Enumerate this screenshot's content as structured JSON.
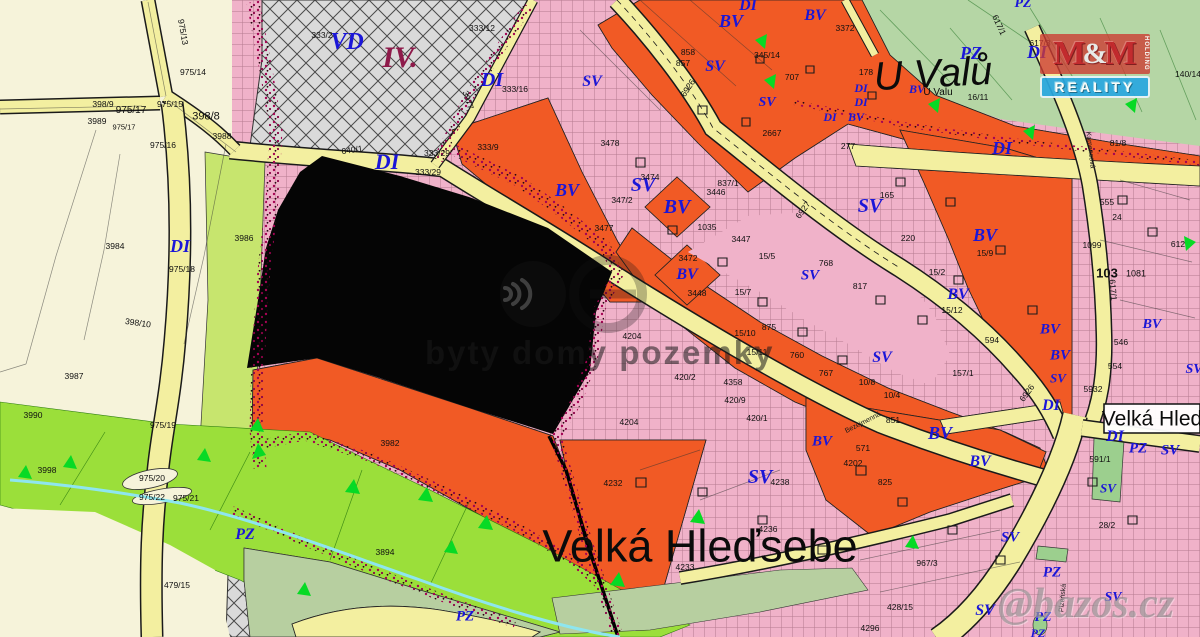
{
  "map": {
    "title": "Velká Hleďsebe zoning plan",
    "zone_labels": [
      {
        "t": "VD",
        "x": 347,
        "y": 42,
        "s": 24
      },
      {
        "t": "IV.",
        "x": 400,
        "y": 58,
        "s": 30,
        "c": "#8e1a4a"
      },
      {
        "t": "DI",
        "x": 492,
        "y": 80,
        "s": 20
      },
      {
        "t": "DI",
        "x": 387,
        "y": 162,
        "s": 22
      },
      {
        "t": "DI",
        "x": 180,
        "y": 246,
        "s": 18
      },
      {
        "t": "DI",
        "x": 748,
        "y": 6,
        "s": 16
      },
      {
        "t": "BV",
        "x": 731,
        "y": 21,
        "s": 18
      },
      {
        "t": "BV",
        "x": 815,
        "y": 16,
        "s": 16
      },
      {
        "t": "SV",
        "x": 715,
        "y": 67,
        "s": 16
      },
      {
        "t": "SV",
        "x": 767,
        "y": 103,
        "s": 14
      },
      {
        "t": "SV",
        "x": 592,
        "y": 82,
        "s": 16
      },
      {
        "t": "SV",
        "x": 643,
        "y": 185,
        "s": 20
      },
      {
        "t": "BV",
        "x": 677,
        "y": 207,
        "s": 20
      },
      {
        "t": "BV",
        "x": 567,
        "y": 190,
        "s": 18
      },
      {
        "t": "BV",
        "x": 687,
        "y": 275,
        "s": 16
      },
      {
        "t": "SV",
        "x": 870,
        "y": 206,
        "s": 20
      },
      {
        "t": "SV",
        "x": 810,
        "y": 276,
        "s": 15
      },
      {
        "t": "SV",
        "x": 882,
        "y": 358,
        "s": 16
      },
      {
        "t": "BV",
        "x": 985,
        "y": 235,
        "s": 18
      },
      {
        "t": "BV",
        "x": 958,
        "y": 295,
        "s": 16
      },
      {
        "t": "BV",
        "x": 1050,
        "y": 330,
        "s": 15
      },
      {
        "t": "BV",
        "x": 1060,
        "y": 356,
        "s": 15
      },
      {
        "t": "SV",
        "x": 1058,
        "y": 378,
        "s": 13
      },
      {
        "t": "BV",
        "x": 1152,
        "y": 325,
        "s": 14
      },
      {
        "t": "SV",
        "x": 1194,
        "y": 370,
        "s": 14
      },
      {
        "t": "DI",
        "x": 1002,
        "y": 148,
        "s": 18
      },
      {
        "t": "PZ",
        "x": 971,
        "y": 53,
        "s": 18
      },
      {
        "t": "DI",
        "x": 1037,
        "y": 52,
        "s": 18
      },
      {
        "t": "PZ",
        "x": 1023,
        "y": 4,
        "s": 14
      },
      {
        "t": "DI",
        "x": 861,
        "y": 88,
        "s": 12
      },
      {
        "t": "DI",
        "x": 861,
        "y": 102,
        "s": 12
      },
      {
        "t": "DI",
        "x": 830,
        "y": 117,
        "s": 12
      },
      {
        "t": "BV",
        "x": 856,
        "y": 117,
        "s": 12
      },
      {
        "t": "BV",
        "x": 917,
        "y": 89,
        "s": 12
      },
      {
        "t": "DI",
        "x": 1051,
        "y": 406,
        "s": 16
      },
      {
        "t": "DI",
        "x": 1115,
        "y": 437,
        "s": 16
      },
      {
        "t": "PZ",
        "x": 1138,
        "y": 449,
        "s": 15
      },
      {
        "t": "SV",
        "x": 1170,
        "y": 451,
        "s": 15
      },
      {
        "t": "SV",
        "x": 1108,
        "y": 488,
        "s": 13
      },
      {
        "t": "BV",
        "x": 940,
        "y": 433,
        "s": 18
      },
      {
        "t": "BV",
        "x": 980,
        "y": 462,
        "s": 16
      },
      {
        "t": "BV",
        "x": 822,
        "y": 442,
        "s": 15
      },
      {
        "t": "SV",
        "x": 760,
        "y": 477,
        "s": 20
      },
      {
        "t": "SV",
        "x": 1010,
        "y": 538,
        "s": 15
      },
      {
        "t": "PZ",
        "x": 1052,
        "y": 573,
        "s": 15
      },
      {
        "t": "SV",
        "x": 985,
        "y": 611,
        "s": 16
      },
      {
        "t": "PZ",
        "x": 1043,
        "y": 618,
        "s": 14
      },
      {
        "t": "PZ",
        "x": 1038,
        "y": 633,
        "s": 12
      },
      {
        "t": "SV",
        "x": 1113,
        "y": 598,
        "s": 14
      },
      {
        "t": "PZ",
        "x": 245,
        "y": 535,
        "s": 16
      },
      {
        "t": "PZ",
        "x": 465,
        "y": 617,
        "s": 15
      }
    ],
    "parcel_labels": [
      {
        "t": "398/9",
        "x": 103,
        "y": 104
      },
      {
        "t": "975/17",
        "x": 131,
        "y": 111,
        "s": 10
      },
      {
        "t": "3989",
        "x": 97,
        "y": 121
      },
      {
        "t": "975/17",
        "x": 124,
        "y": 127,
        "s": 7.5
      },
      {
        "t": "975/15",
        "x": 170,
        "y": 104
      },
      {
        "t": "398/8",
        "x": 206,
        "y": 117,
        "s": 11
      },
      {
        "t": "975/13",
        "x": 183,
        "y": 32,
        "r": 80
      },
      {
        "t": "975/14",
        "x": 193,
        "y": 72
      },
      {
        "t": "975/16",
        "x": 163,
        "y": 145
      },
      {
        "t": "3988",
        "x": 222,
        "y": 136
      },
      {
        "t": "640/1",
        "x": 352,
        "y": 150,
        "r": -8
      },
      {
        "t": "333/2",
        "x": 322,
        "y": 35
      },
      {
        "t": "333/12",
        "x": 482,
        "y": 28
      },
      {
        "t": "333/16",
        "x": 515,
        "y": 89
      },
      {
        "t": "3977",
        "x": 468,
        "y": 100,
        "r": 72
      },
      {
        "t": "333/29",
        "x": 437,
        "y": 153
      },
      {
        "t": "333/29",
        "x": 428,
        "y": 172
      },
      {
        "t": "3984",
        "x": 115,
        "y": 246
      },
      {
        "t": "975/18",
        "x": 182,
        "y": 269
      },
      {
        "t": "3986",
        "x": 244,
        "y": 238
      },
      {
        "t": "398/10",
        "x": 138,
        "y": 323,
        "r": 8
      },
      {
        "t": "3987",
        "x": 74,
        "y": 376
      },
      {
        "t": "3990",
        "x": 33,
        "y": 415
      },
      {
        "t": "975/19",
        "x": 163,
        "y": 425
      },
      {
        "t": "3998",
        "x": 47,
        "y": 470
      },
      {
        "t": "975/20",
        "x": 152,
        "y": 478
      },
      {
        "t": "975/22",
        "x": 152,
        "y": 497
      },
      {
        "t": "975/21",
        "x": 186,
        "y": 498
      },
      {
        "t": "479/15",
        "x": 177,
        "y": 585
      },
      {
        "t": "3894",
        "x": 385,
        "y": 552
      },
      {
        "t": "3982",
        "x": 390,
        "y": 443
      },
      {
        "t": "3478",
        "x": 610,
        "y": 143
      },
      {
        "t": "3474",
        "x": 650,
        "y": 177
      },
      {
        "t": "347/2",
        "x": 622,
        "y": 200
      },
      {
        "t": "3477",
        "x": 604,
        "y": 228
      },
      {
        "t": "333/9",
        "x": 488,
        "y": 147
      },
      {
        "t": "837/1",
        "x": 728,
        "y": 183
      },
      {
        "t": "3446",
        "x": 716,
        "y": 192
      },
      {
        "t": "1035",
        "x": 707,
        "y": 227
      },
      {
        "t": "3447",
        "x": 741,
        "y": 239
      },
      {
        "t": "3472",
        "x": 688,
        "y": 258
      },
      {
        "t": "3448",
        "x": 697,
        "y": 293
      },
      {
        "t": "2667",
        "x": 772,
        "y": 133
      },
      {
        "t": "858",
        "x": 688,
        "y": 52
      },
      {
        "t": "857",
        "x": 683,
        "y": 63
      },
      {
        "t": "345/14",
        "x": 767,
        "y": 55
      },
      {
        "t": "707",
        "x": 792,
        "y": 77
      },
      {
        "t": "3372",
        "x": 845,
        "y": 28
      },
      {
        "t": "277",
        "x": 848,
        "y": 146
      },
      {
        "t": "178",
        "x": 866,
        "y": 72
      },
      {
        "t": "16/11",
        "x": 978,
        "y": 97
      },
      {
        "t": "140/14",
        "x": 1188,
        "y": 74
      },
      {
        "t": "617/3",
        "x": 1040,
        "y": 43
      },
      {
        "t": "617/1",
        "x": 999,
        "y": 25,
        "r": 65
      },
      {
        "t": "165",
        "x": 887,
        "y": 195
      },
      {
        "t": "220",
        "x": 908,
        "y": 238
      },
      {
        "t": "15/5",
        "x": 767,
        "y": 256
      },
      {
        "t": "15/7",
        "x": 743,
        "y": 292
      },
      {
        "t": "15/10",
        "x": 745,
        "y": 333
      },
      {
        "t": "15/11",
        "x": 757,
        "y": 352
      },
      {
        "t": "15/9",
        "x": 985,
        "y": 253
      },
      {
        "t": "15/2",
        "x": 937,
        "y": 272
      },
      {
        "t": "15/12",
        "x": 952,
        "y": 310
      },
      {
        "t": "768",
        "x": 826,
        "y": 263
      },
      {
        "t": "817",
        "x": 860,
        "y": 286
      },
      {
        "t": "875",
        "x": 769,
        "y": 327
      },
      {
        "t": "760",
        "x": 797,
        "y": 355
      },
      {
        "t": "767",
        "x": 826,
        "y": 373
      },
      {
        "t": "851",
        "x": 893,
        "y": 420
      },
      {
        "t": "10/8",
        "x": 867,
        "y": 382
      },
      {
        "t": "10/4",
        "x": 892,
        "y": 395
      },
      {
        "t": "4204",
        "x": 632,
        "y": 336
      },
      {
        "t": "4204",
        "x": 629,
        "y": 422
      },
      {
        "t": "420/2",
        "x": 685,
        "y": 377
      },
      {
        "t": "4358",
        "x": 733,
        "y": 382
      },
      {
        "t": "420/9",
        "x": 735,
        "y": 400
      },
      {
        "t": "420/1",
        "x": 757,
        "y": 418
      },
      {
        "t": "594",
        "x": 992,
        "y": 340
      },
      {
        "t": "157/1",
        "x": 963,
        "y": 373
      },
      {
        "t": "555",
        "x": 1107,
        "y": 202
      },
      {
        "t": "24",
        "x": 1117,
        "y": 217
      },
      {
        "t": "1099",
        "x": 1092,
        "y": 245
      },
      {
        "t": "612",
        "x": 1178,
        "y": 244
      },
      {
        "t": "81/8",
        "x": 1118,
        "y": 143
      },
      {
        "t": "103",
        "x": 1107,
        "y": 273,
        "s": 13,
        "w": 700
      },
      {
        "t": "1081",
        "x": 1136,
        "y": 274,
        "s": 9
      },
      {
        "t": "617/1",
        "x": 1113,
        "y": 290,
        "r": 85
      },
      {
        "t": "546",
        "x": 1121,
        "y": 342
      },
      {
        "t": "554",
        "x": 1115,
        "y": 366
      },
      {
        "t": "5932",
        "x": 1093,
        "y": 389
      },
      {
        "t": "591/1",
        "x": 1100,
        "y": 459
      },
      {
        "t": "28/2",
        "x": 1107,
        "y": 525
      },
      {
        "t": "4232",
        "x": 613,
        "y": 483
      },
      {
        "t": "4238",
        "x": 780,
        "y": 482
      },
      {
        "t": "4236",
        "x": 768,
        "y": 529
      },
      {
        "t": "4233",
        "x": 685,
        "y": 567
      },
      {
        "t": "4202",
        "x": 853,
        "y": 463
      },
      {
        "t": "571",
        "x": 863,
        "y": 448
      },
      {
        "t": "825",
        "x": 885,
        "y": 482
      },
      {
        "t": "428/15",
        "x": 900,
        "y": 607
      },
      {
        "t": "4296",
        "x": 870,
        "y": 628
      },
      {
        "t": "967/3",
        "x": 927,
        "y": 563
      },
      {
        "t": "6927",
        "x": 803,
        "y": 210,
        "r": -54
      },
      {
        "t": "6926",
        "x": 1027,
        "y": 393,
        "r": -54
      },
      {
        "t": "6926",
        "x": 688,
        "y": 88,
        "r": -56
      }
    ],
    "street_labels": [
      {
        "t": "Bezejmenná",
        "x": 863,
        "y": 423,
        "s": 7,
        "r": -27
      },
      {
        "t": "Kamencová",
        "x": 1090,
        "y": 150,
        "s": 7,
        "r": 83
      },
      {
        "t": "Plzeňská",
        "x": 1063,
        "y": 598,
        "s": 7,
        "r": -85
      }
    ],
    "place_labels": [
      {
        "t": "U Valů",
        "x": 933,
        "y": 74,
        "s": 40,
        "r": -3,
        "i": 1
      },
      {
        "t": "U Valu",
        "x": 938,
        "y": 93,
        "s": 10
      },
      {
        "t": "Velká Hleďsebe",
        "x": 700,
        "y": 546,
        "s": 45
      },
      {
        "t": "Velká Hled",
        "x": 1152,
        "y": 419,
        "s": 21
      }
    ],
    "watermark": {
      "center_text": "byty domy pozemky",
      "corner_text": "@bazos.cz"
    },
    "logo": {
      "m1": "M",
      "amp": "&",
      "m2": "M",
      "reality": "REALITY",
      "holding": "HOLDING"
    },
    "colors": {
      "cream": "#f6f3da",
      "pink_sv": "#f0b2c9",
      "orange_bv": "#f15a25",
      "gray_vd": "#dadada",
      "green_pz": "#b5d6a5",
      "lime_strip": "#9bdf3a",
      "road_yellow": "#f3efa0",
      "label_blue": "#1b16d8",
      "speckle": "#a50453",
      "stream_cyan": "#8ee6ef",
      "redacted": "#000000"
    }
  }
}
